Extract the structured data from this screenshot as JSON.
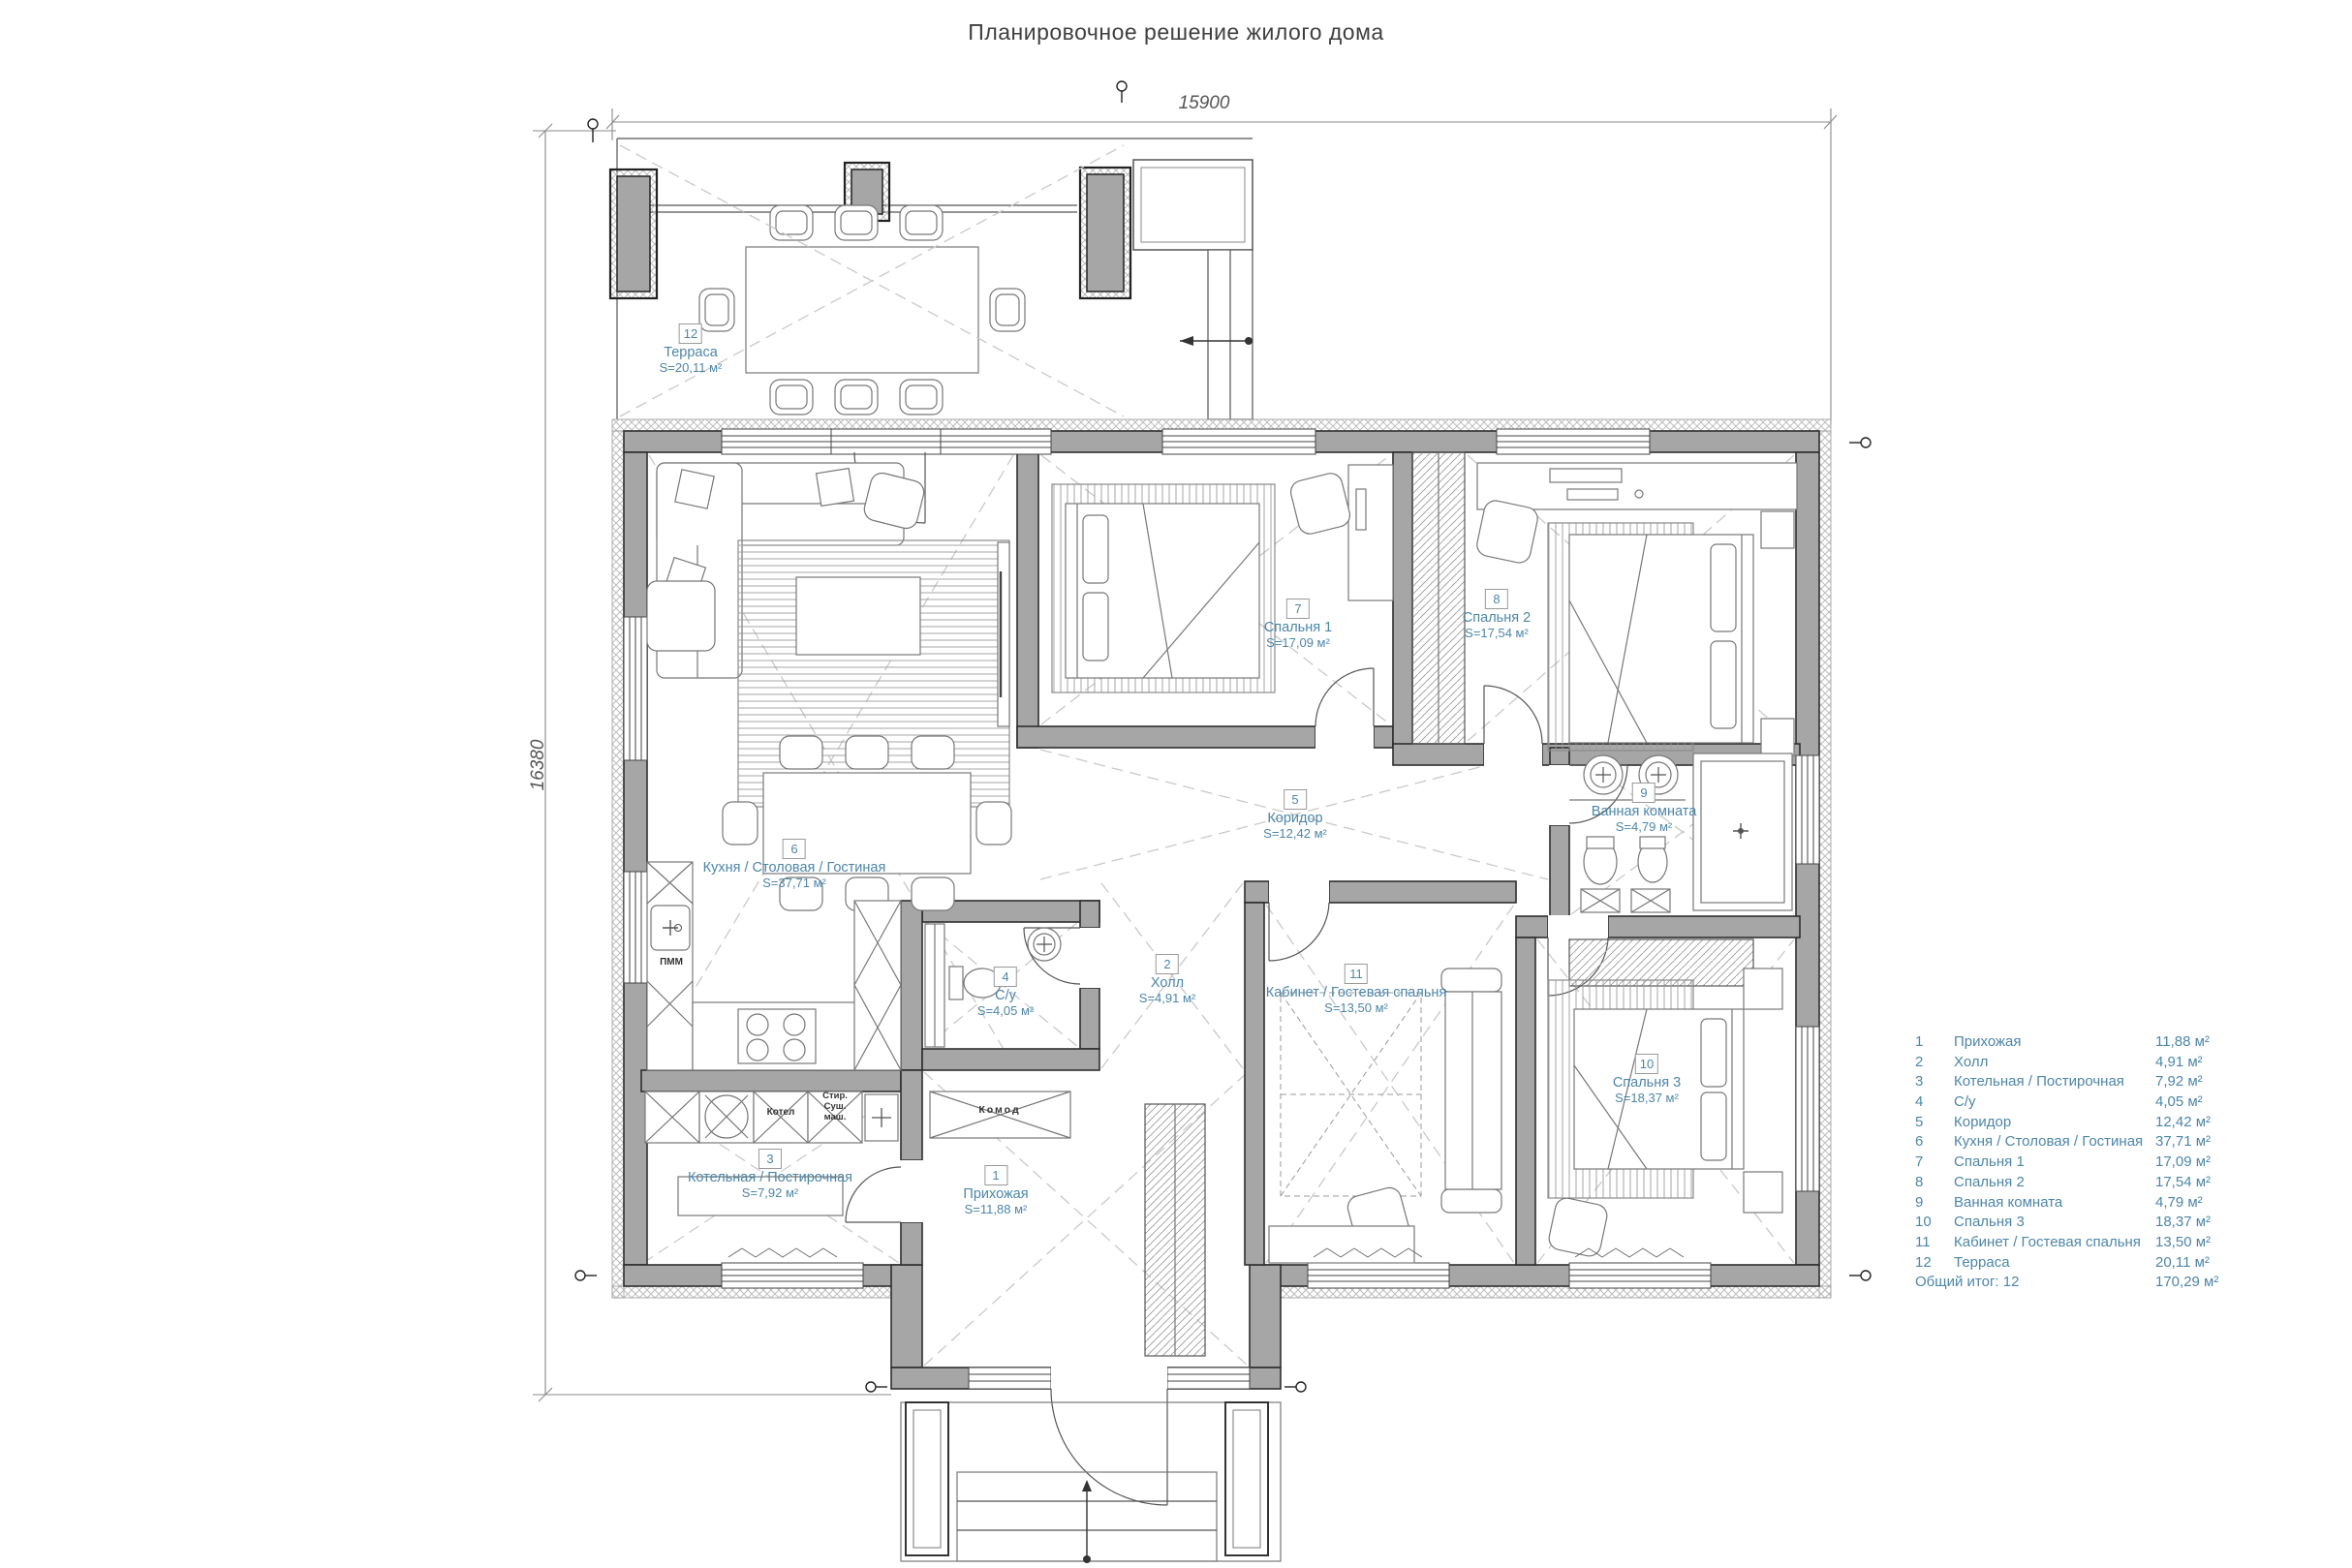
{
  "title": "Планировочное решение жилого дома",
  "dimensions": {
    "top": "15900",
    "left": "16380"
  },
  "rooms": [
    {
      "num": "1",
      "name": "Прихожая",
      "area": "11,88 м²",
      "plan_area": "S=11,88 м²"
    },
    {
      "num": "2",
      "name": "Холл",
      "area": "4,91 м²",
      "plan_area": "S=4,91 м²"
    },
    {
      "num": "3",
      "name": "Котельная / Постирочная",
      "area": "7,92 м²",
      "plan_area": "S=7,92 м²"
    },
    {
      "num": "4",
      "name": "С/у",
      "area": "4,05 м²",
      "plan_area": "S=4,05 м²"
    },
    {
      "num": "5",
      "name": "Коридор",
      "area": "12,42 м²",
      "plan_area": "S=12,42 м²"
    },
    {
      "num": "6",
      "name": "Кухня / Столовая / Гостиная",
      "area": "37,71 м²",
      "plan_area": "S=37,71 м²"
    },
    {
      "num": "7",
      "name": "Спальня 1",
      "area": "17,09 м²",
      "plan_area": "S=17,09 м²"
    },
    {
      "num": "8",
      "name": "Спальня 2",
      "area": "17,54 м²",
      "plan_area": "S=17,54 м²"
    },
    {
      "num": "9",
      "name": "Ванная комната",
      "area": "4,79 м²",
      "plan_area": "S=4,79 м²"
    },
    {
      "num": "10",
      "name": "Спальня 3",
      "area": "18,37 м²",
      "plan_area": "S=18,37 м²"
    },
    {
      "num": "11",
      "name": "Кабинет / Гостевая спальня",
      "area": "13,50 м²",
      "plan_area": "S=13,50 м²"
    },
    {
      "num": "12",
      "name": "Терраса",
      "area": "20,11 м²",
      "plan_area": "S=20,11 м²"
    }
  ],
  "legend": {
    "total_label": "Общий итог: 12",
    "total_value": "170,29 м²"
  },
  "annotations": {
    "komod": "Комод",
    "kotel": "Котел",
    "stir_sush": "Стир.\nСуш.\nмаш.",
    "pmm": "ПММ"
  },
  "colors": {
    "label_blue": "#4d86a8",
    "wall_gray": "#a6a6a6"
  }
}
